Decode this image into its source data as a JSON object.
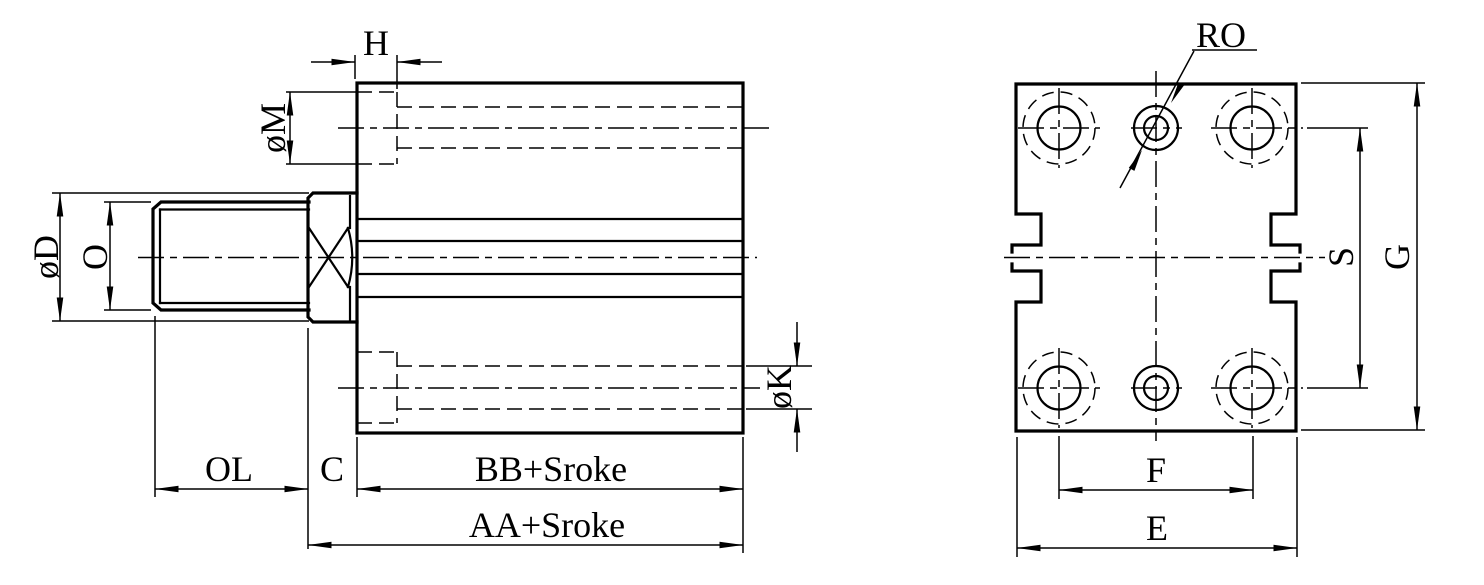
{
  "colors": {
    "background": "#ffffff",
    "line": "#000000"
  },
  "side_view": {
    "labels": {
      "h": "H",
      "m": "øM",
      "d": "øD",
      "o": "O",
      "k": "øK",
      "ol": "OL",
      "c": "C",
      "bb": "BB+Sroke",
      "aa": "AA+Sroke"
    }
  },
  "end_view": {
    "labels": {
      "ro": "RO",
      "s": "S",
      "g": "G",
      "f": "F",
      "e": "E"
    }
  }
}
